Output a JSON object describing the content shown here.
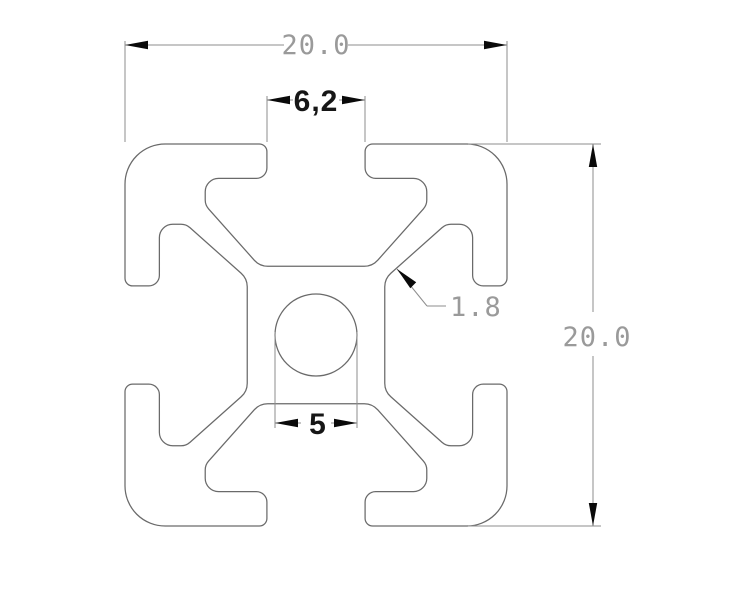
{
  "drawing": {
    "object": "20x20 aluminium T-slot extrusion profile cross-section",
    "background": "#ffffff",
    "outline_color": "#6a6a6a",
    "dim_line_color": "#8e8e8e",
    "arrow_color": "#0a0a0a",
    "gray_text_color": "#9a9a9a",
    "dark_text_color": "#161616"
  },
  "dimensions": {
    "overall_width": "20.0",
    "overall_height": "20.0",
    "slot_opening": "6,2",
    "center_bore": "5",
    "wall_thickness": "1.8"
  },
  "geometry": {
    "center": [
      316,
      335
    ],
    "scale": 19.1,
    "profile_template_mm": [
      [
        -10,
        -10,
        2.1
      ],
      [
        -2.57,
        -10,
        0.4
      ],
      [
        -2.57,
        -8.2,
        0.55
      ],
      [
        -5.8,
        -8.2,
        0.7
      ],
      [
        -5.8,
        -6.8,
        0.7
      ],
      [
        -2.95,
        -3.6,
        0.95
      ],
      [
        2.95,
        -3.6,
        0.95
      ],
      [
        5.8,
        -6.8,
        0.7
      ],
      [
        5.8,
        -8.2,
        0.7
      ],
      [
        2.57,
        -8.2,
        0.55
      ],
      [
        2.57,
        -10,
        0.4
      ]
    ],
    "bore_radius_px": 41,
    "lines": [
      [
        125,
        41,
        125,
        142
      ],
      [
        507,
        41,
        507,
        142
      ],
      [
        125,
        45,
        284,
        45
      ],
      [
        348,
        45,
        507,
        45
      ],
      [
        267,
        96,
        267,
        142
      ],
      [
        365,
        96,
        365,
        142
      ],
      [
        267,
        100,
        293,
        100
      ],
      [
        339,
        100,
        365,
        100
      ],
      [
        468,
        144,
        601,
        144
      ],
      [
        468,
        526,
        601,
        526
      ],
      [
        593,
        144,
        593,
        312
      ],
      [
        593,
        356,
        593,
        526
      ],
      [
        275,
        332,
        275,
        428
      ],
      [
        357,
        332,
        357,
        428
      ],
      [
        275,
        423,
        301,
        423
      ],
      [
        331,
        423,
        357,
        423
      ],
      [
        397,
        269,
        427,
        306
      ],
      [
        427,
        306,
        446,
        306
      ]
    ],
    "arrows": [
      [
        125,
        45,
        180
      ],
      [
        507,
        45,
        0
      ],
      [
        267,
        100,
        180
      ],
      [
        365,
        100,
        0
      ],
      [
        593,
        144,
        270
      ],
      [
        593,
        526,
        90
      ],
      [
        275,
        423,
        180
      ],
      [
        357,
        423,
        0
      ],
      [
        397,
        269,
        225
      ]
    ],
    "arrow_len": 23,
    "arrow_halfwidth": 4.2,
    "labels": {
      "dim-overall-width-text": {
        "x": 316,
        "y": 54,
        "anchor": "middle"
      },
      "dim-slot-opening-text": {
        "x": 316,
        "y": 111,
        "anchor": "middle"
      },
      "dim-overall-height-text": {
        "x": 597,
        "y": 346,
        "anchor": "middle"
      },
      "dim-center-bore-text": {
        "x": 318,
        "y": 434,
        "anchor": "middle"
      },
      "dim-wall-thickness-text": {
        "x": 450,
        "y": 316,
        "anchor": "start"
      }
    }
  }
}
